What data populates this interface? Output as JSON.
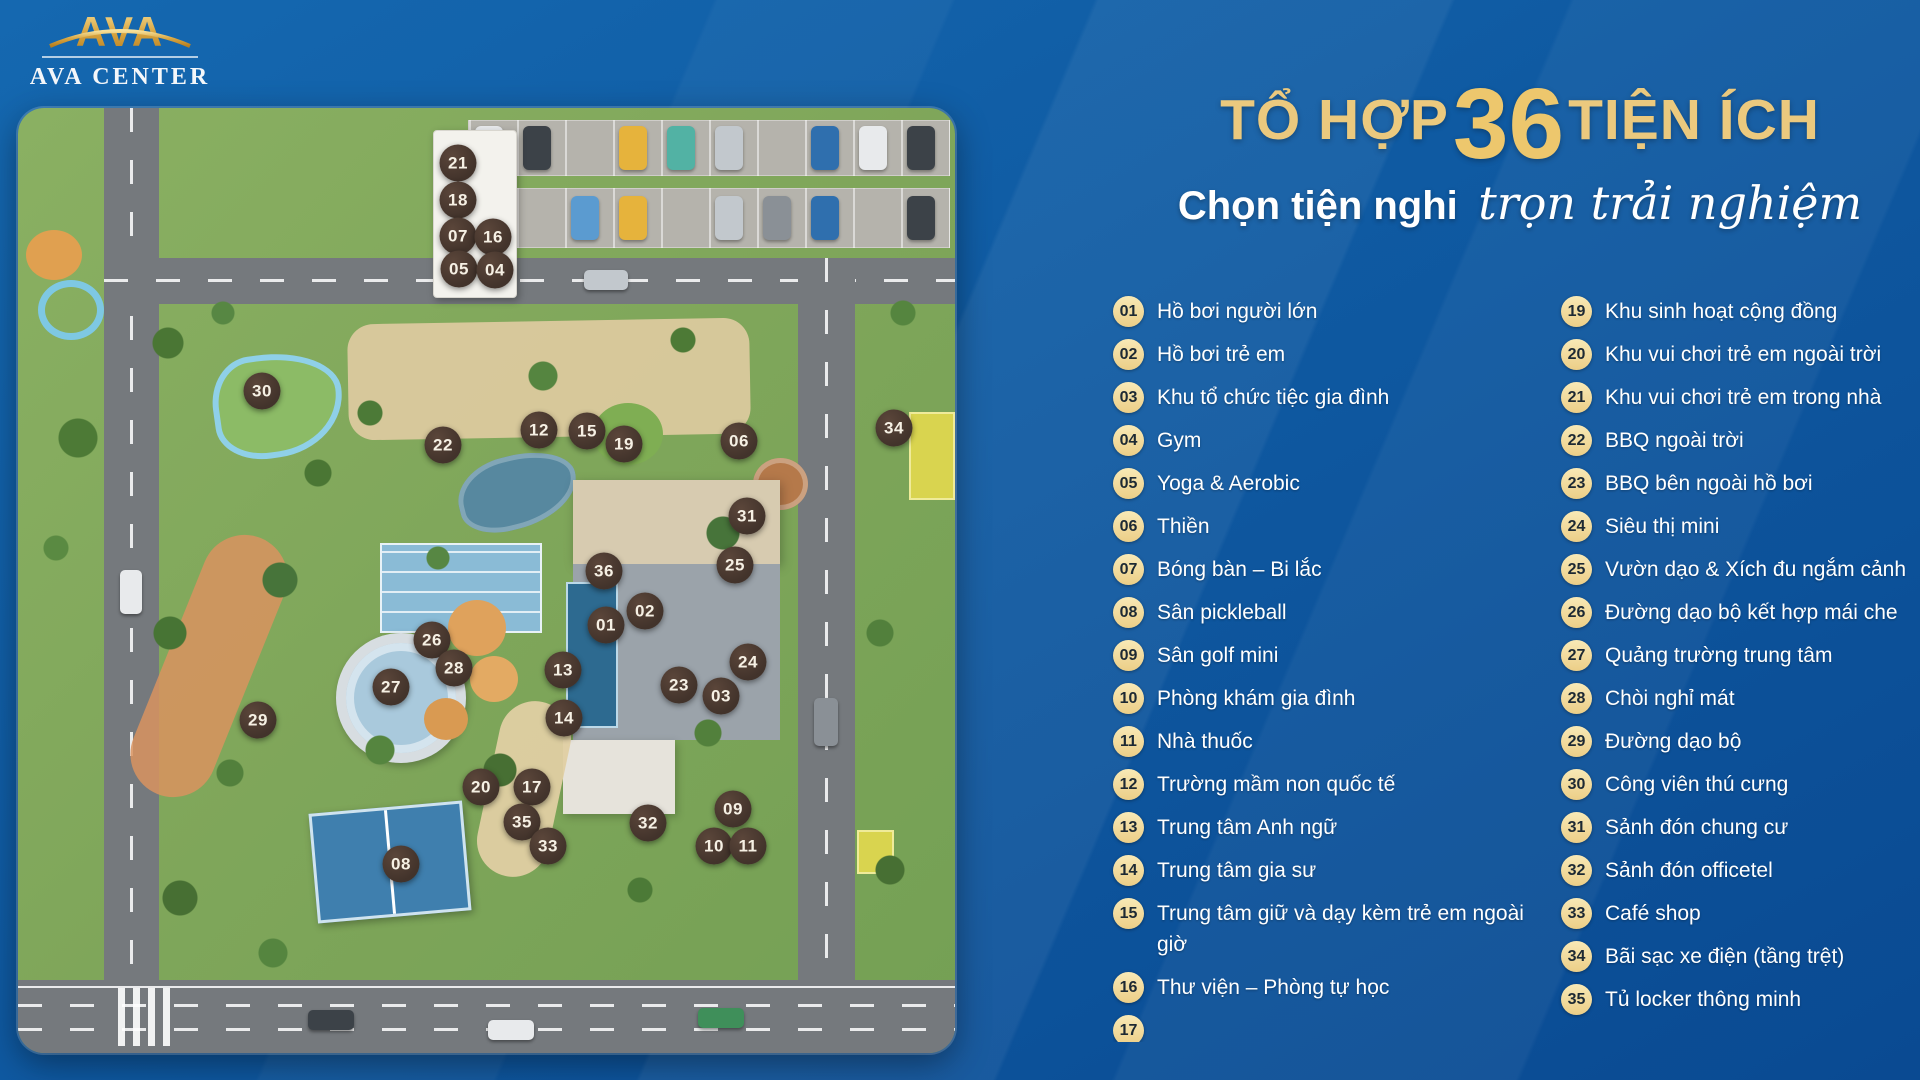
{
  "logo": {
    "mark": "AVA",
    "name": "AVA CENTER"
  },
  "header": {
    "title_prefix": "TỔ HỢP",
    "title_number": "36",
    "title_suffix": "TIỆN ÍCH",
    "subtitle_plain": "Chọn tiện nghi",
    "subtitle_script": "trọn trải nghiệm"
  },
  "colors": {
    "background_blue": "#0f5aa2",
    "title_gold": "#ebc97e",
    "list_badge_cream": "#f1d894",
    "list_text": "#ffffff",
    "map_marker_brown": "#42332b"
  },
  "amenities": {
    "left": [
      {
        "num": "01",
        "label": "Hồ bơi người lớn"
      },
      {
        "num": "02",
        "label": "Hồ bơi trẻ em"
      },
      {
        "num": "03",
        "label": "Khu tổ chức tiệc gia đình"
      },
      {
        "num": "04",
        "label": "Gym"
      },
      {
        "num": "05",
        "label": "Yoga & Aerobic"
      },
      {
        "num": "06",
        "label": "Thiền"
      },
      {
        "num": "07",
        "label": "Bóng bàn – Bi lắc"
      },
      {
        "num": "08",
        "label": "Sân pickleball"
      },
      {
        "num": "09",
        "label": "Sân golf mini"
      },
      {
        "num": "10",
        "label": "Phòng khám gia đình"
      },
      {
        "num": "11",
        "label": "Nhà thuốc"
      },
      {
        "num": "12",
        "label": "Trường mầm non quốc tế"
      },
      {
        "num": "13",
        "label": "Trung tâm Anh ngữ"
      },
      {
        "num": "14",
        "label": "Trung tâm gia sư"
      },
      {
        "num": "15",
        "label": "Trung tâm giữ và dạy kèm trẻ em ngoài giờ"
      },
      {
        "num": "16",
        "label": "Thư viện – Phòng tự học"
      }
    ],
    "right": [
      {
        "num": "19",
        "label": "Khu sinh hoạt cộng đồng"
      },
      {
        "num": "20",
        "label": "Khu vui chơi trẻ em ngoài trời"
      },
      {
        "num": "21",
        "label": "Khu vui chơi trẻ em trong nhà"
      },
      {
        "num": "22",
        "label": "BBQ ngoài trời"
      },
      {
        "num": "23",
        "label": "BBQ bên ngoài hồ bơi"
      },
      {
        "num": "24",
        "label": "Siêu thị mini"
      },
      {
        "num": "25",
        "label": "Vườn dạo & Xích đu ngắm cảnh"
      },
      {
        "num": "26",
        "label": "Đường dạo bộ kết hợp mái che"
      },
      {
        "num": "27",
        "label": "Quảng trường trung tâm"
      },
      {
        "num": "28",
        "label": "Chòi nghỉ mát"
      },
      {
        "num": "29",
        "label": "Đường dạo bộ"
      },
      {
        "num": "30",
        "label": "Công viên thú cưng"
      },
      {
        "num": "31",
        "label": "Sảnh đón chung cư"
      },
      {
        "num": "32",
        "label": "Sảnh đón officetel"
      },
      {
        "num": "33",
        "label": "Café shop"
      },
      {
        "num": "34",
        "label": "Bãi sạc xe điện (tầng trệt)"
      },
      {
        "num": "35",
        "label": "Tủ locker thông minh"
      }
    ],
    "partial_next": "17"
  },
  "map": {
    "markers": [
      {
        "num": "21",
        "x": 440,
        "y": 55
      },
      {
        "num": "18",
        "x": 440,
        "y": 92
      },
      {
        "num": "07",
        "x": 440,
        "y": 128
      },
      {
        "num": "16",
        "x": 475,
        "y": 129
      },
      {
        "num": "05",
        "x": 441,
        "y": 161
      },
      {
        "num": "04",
        "x": 477,
        "y": 162
      },
      {
        "num": "30",
        "x": 244,
        "y": 283
      },
      {
        "num": "22",
        "x": 425,
        "y": 337
      },
      {
        "num": "12",
        "x": 521,
        "y": 322
      },
      {
        "num": "15",
        "x": 569,
        "y": 323
      },
      {
        "num": "19",
        "x": 606,
        "y": 336
      },
      {
        "num": "06",
        "x": 721,
        "y": 333
      },
      {
        "num": "34",
        "x": 876,
        "y": 320
      },
      {
        "num": "31",
        "x": 729,
        "y": 408
      },
      {
        "num": "36",
        "x": 586,
        "y": 463
      },
      {
        "num": "25",
        "x": 717,
        "y": 457
      },
      {
        "num": "02",
        "x": 627,
        "y": 503
      },
      {
        "num": "01",
        "x": 588,
        "y": 517
      },
      {
        "num": "26",
        "x": 414,
        "y": 532
      },
      {
        "num": "28",
        "x": 436,
        "y": 560
      },
      {
        "num": "27",
        "x": 373,
        "y": 579
      },
      {
        "num": "13",
        "x": 545,
        "y": 562
      },
      {
        "num": "24",
        "x": 730,
        "y": 554
      },
      {
        "num": "23",
        "x": 661,
        "y": 577
      },
      {
        "num": "03",
        "x": 703,
        "y": 588
      },
      {
        "num": "29",
        "x": 240,
        "y": 612
      },
      {
        "num": "14",
        "x": 546,
        "y": 610
      },
      {
        "num": "20",
        "x": 463,
        "y": 679
      },
      {
        "num": "17",
        "x": 514,
        "y": 679
      },
      {
        "num": "35",
        "x": 504,
        "y": 714
      },
      {
        "num": "33",
        "x": 530,
        "y": 738
      },
      {
        "num": "32",
        "x": 630,
        "y": 715
      },
      {
        "num": "09",
        "x": 715,
        "y": 701
      },
      {
        "num": "10",
        "x": 696,
        "y": 738
      },
      {
        "num": "11",
        "x": 730,
        "y": 738
      },
      {
        "num": "08",
        "x": 383,
        "y": 756
      }
    ]
  }
}
